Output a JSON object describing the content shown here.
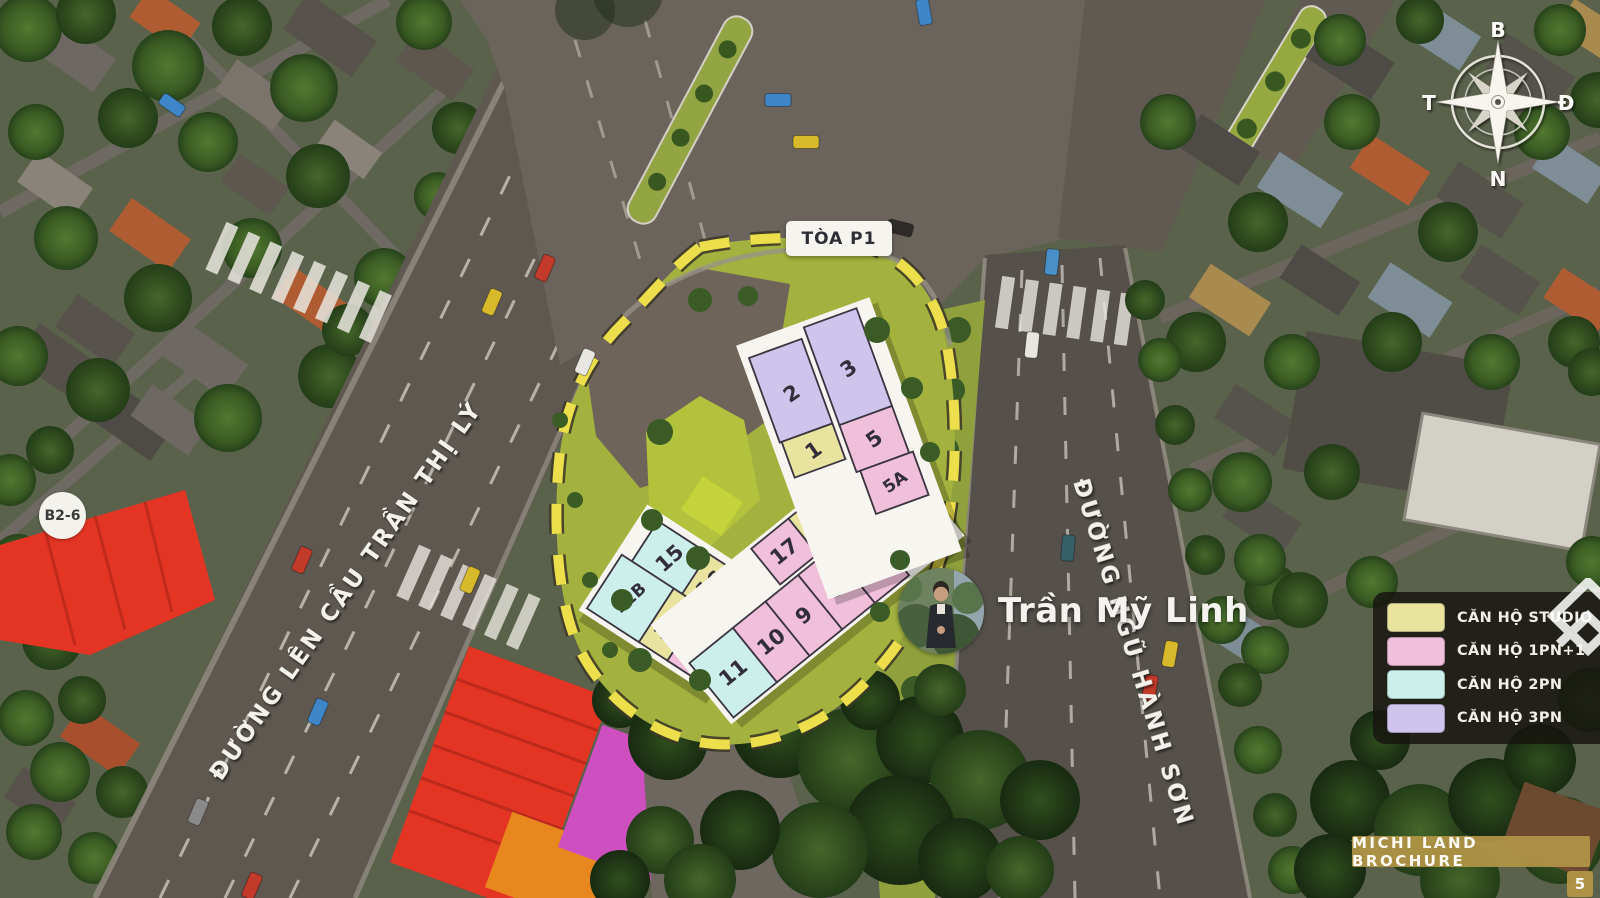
{
  "site": {
    "building_label": "TÒA P1",
    "units": {
      "u1": {
        "id": "1",
        "type": "CĂN HỘ STUDIO",
        "color": "#e8e4a0"
      },
      "u2": {
        "id": "2",
        "type": "CĂN HỘ 3PN",
        "color": "#cfc5ec"
      },
      "u3": {
        "id": "3",
        "type": "CĂN HỘ 3PN",
        "color": "#cfc5ec"
      },
      "u5": {
        "id": "5",
        "type": "CĂN HỘ 1PN+1",
        "color": "#f0bfda"
      },
      "u5a": {
        "id": "5A",
        "type": "CĂN HỘ 1PN+1",
        "color": "#f0bfda"
      },
      "u6": {
        "id": "6",
        "type": "CĂN HỘ 2PN",
        "color": "#cdefeb"
      },
      "u7": {
        "id": "7",
        "type": "CĂN HỘ 1PN+1",
        "color": "#f0bfda"
      },
      "u8": {
        "id": "8",
        "type": "CĂN HỘ 1PN+1",
        "color": "#f0bfda"
      },
      "u9": {
        "id": "9",
        "type": "CĂN HỘ 1PN+1",
        "color": "#f0bfda"
      },
      "u10": {
        "id": "10",
        "type": "CĂN HỘ 1PN+1",
        "color": "#f0bfda"
      },
      "u11": {
        "id": "11",
        "type": "CĂN HỘ 2PN",
        "color": "#cdefeb"
      },
      "u12": {
        "id": "12",
        "type": "CĂN HỘ 1PN+1",
        "color": "#f0bfda"
      },
      "u12a": {
        "id": "12A",
        "type": "CĂN HỘ STUDIO",
        "color": "#e8e4a0"
      },
      "u12b": {
        "id": "12B",
        "type": "CĂN HỘ 2PN",
        "color": "#cdefeb"
      },
      "u15": {
        "id": "15",
        "type": "CĂN HỘ 2PN",
        "color": "#cdefeb"
      },
      "u16": {
        "id": "16",
        "type": "CĂN HỘ STUDIO",
        "color": "#e8e4a0"
      },
      "u17": {
        "id": "17",
        "type": "CĂN HỘ 1PN+1",
        "color": "#f0bfda"
      },
      "u18": {
        "id": "18",
        "type": "CĂN HỘ STUDIO",
        "color": "#e8e4a0"
      }
    }
  },
  "streets": {
    "left_street": "ĐƯỜNG LÊN CẦU TRẦN THỊ LÝ",
    "right_street": "ĐƯỜNG NGŨ HÀNH SƠN"
  },
  "compass": {
    "north": "B",
    "east": "Đ",
    "south": "N",
    "west": "T"
  },
  "landmarks": {
    "b2_6": "B2-6"
  },
  "legend": {
    "items": [
      {
        "label": "CĂN HỘ STUDIO",
        "color": "#e8e4a0"
      },
      {
        "label": "CĂN HỘ 1PN+1",
        "color": "#f0bfda"
      },
      {
        "label": "CĂN HỘ 2PN",
        "color": "#cdefeb"
      },
      {
        "label": "CĂN HỘ 3PN",
        "color": "#cfc5ec"
      }
    ]
  },
  "watermark": {
    "agent_name": "Trần Mỹ Linh"
  },
  "brochure": {
    "banner": "MICHI LAND BROCHURE",
    "page": "5"
  }
}
